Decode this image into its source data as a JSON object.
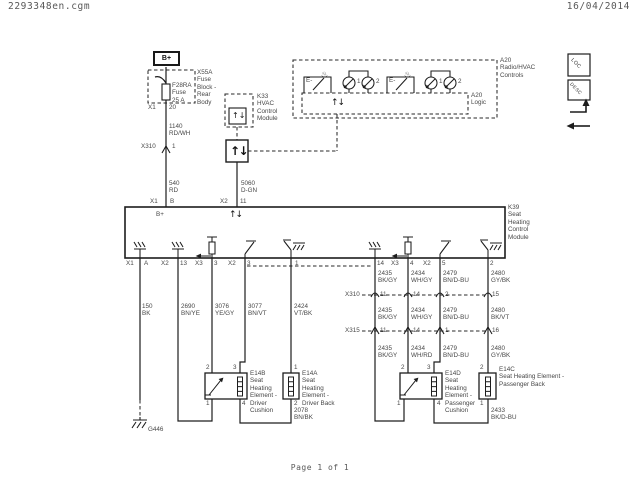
{
  "header": {
    "filename": "2293348en.cgm",
    "date": "16/04/2014"
  },
  "footer": {
    "page_label": "Page 1 of 1"
  },
  "icon_panel": {
    "loc_label": "LOC",
    "desc_label": "DESC"
  },
  "power_feed": {
    "battery_label": "B+",
    "fuse_block_label": "X55A\nFuse\nBlock -\nRear\nBody",
    "fuse_label": "F28RA\nFuse\n25 A",
    "fuse_conn": "X1",
    "fuse_pin": "20",
    "wire_upper": "1140\nRD/WH",
    "inline_conn": "X310",
    "inline_pin": "1",
    "wire_lower": "540\nRD",
    "module_conn": "X1",
    "module_pin": "B",
    "internal_label": "B+"
  },
  "serial_data": {
    "k33_label": "K33\nHVAC\nControl\nModule",
    "gateway_icon": "↑↓",
    "node_icon": "↑↓",
    "module_icon": "↑↓",
    "logic_icon": "↑↓",
    "wire": "5060\nD-GN",
    "module_conn": "X2",
    "module_pin": "11"
  },
  "a20": {
    "label": "A20\nRadio/HVAC\nControls",
    "logic_label": "A20\nLogic",
    "switch_left_label": "E-",
    "switch_right_label": "E-",
    "heat_left_icon": "♨",
    "heat_right_icon": "♨",
    "led_left_1": "1",
    "led_left_2": "2",
    "led_right_1": "1",
    "led_right_2": "2"
  },
  "k39": {
    "label": "K39\nSeat\nHeating\nControl\nModule",
    "pins": [
      {
        "conn": "X1",
        "pin": "A"
      },
      {
        "conn": "X2",
        "pin": "13"
      },
      {
        "conn": "X3",
        "pin": "3"
      },
      {
        "conn": "X2",
        "pin": "3"
      },
      {
        "conn": "",
        "pin": "1"
      },
      {
        "conn": "",
        "pin": "14"
      },
      {
        "conn": "X3",
        "pin": "4"
      },
      {
        "conn": "X2",
        "pin": "5"
      },
      {
        "conn": "",
        "pin": "2"
      }
    ]
  },
  "left_wires": {
    "w1": "150\nBK",
    "w2": "2690\nBN/YE",
    "w3": "3076\nYE/GY",
    "w4": "3077\nBN/VT",
    "w5": "2424\nVT/BK"
  },
  "right_wires": {
    "seg_a": {
      "w1": "2435\nBK/GY",
      "w2": "2434\nWH/GY",
      "w3": "2479\nBN/D-BU",
      "w4": "2480\nGY/BK"
    },
    "x310": {
      "name": "X310",
      "p1": "11",
      "p2": "14",
      "p3": "2",
      "p4": "15"
    },
    "seg_b": {
      "w1": "2435\nBK/GY",
      "w2": "2434\nWH/GY",
      "w3": "2479\nBN/D-BU",
      "w4": "2480\nBK/VT"
    },
    "x315": {
      "name": "X315",
      "p1": "11",
      "p2": "14",
      "p3": "1",
      "p4": "16"
    },
    "seg_c": {
      "w1": "2435\nBK/GY",
      "w2": "2434\nWH/RD",
      "w3": "2479\nBN/D-BU",
      "w4": "2480\nGY/BK"
    }
  },
  "elements": {
    "e14b": {
      "label": "E14B\nSeat\nHeating\nElement -\nDriver\nCushion",
      "pin_tl": "2",
      "pin_tr": "3",
      "pin_bl": "1",
      "pin_br": "4"
    },
    "e14a": {
      "label": "E14A\nSeat\nHeating\nElement -\nDriver Back",
      "pin_top": "1",
      "pin_bottom": "2",
      "wire": "2078\nBN/BK"
    },
    "e14d": {
      "label": "E14D\nSeat\nHeating\nElement -\nPassenger\nCushion",
      "pin_tl": "2",
      "pin_tr": "3",
      "pin_bl": "1",
      "pin_br": "4"
    },
    "e14c": {
      "label": "E14C\nSeat Heating Element -\nPassenger Back",
      "pin_top": "2",
      "pin_bottom": "1",
      "wire": "2433\nBK/D-BU"
    }
  },
  "ground": {
    "label": "G446"
  }
}
